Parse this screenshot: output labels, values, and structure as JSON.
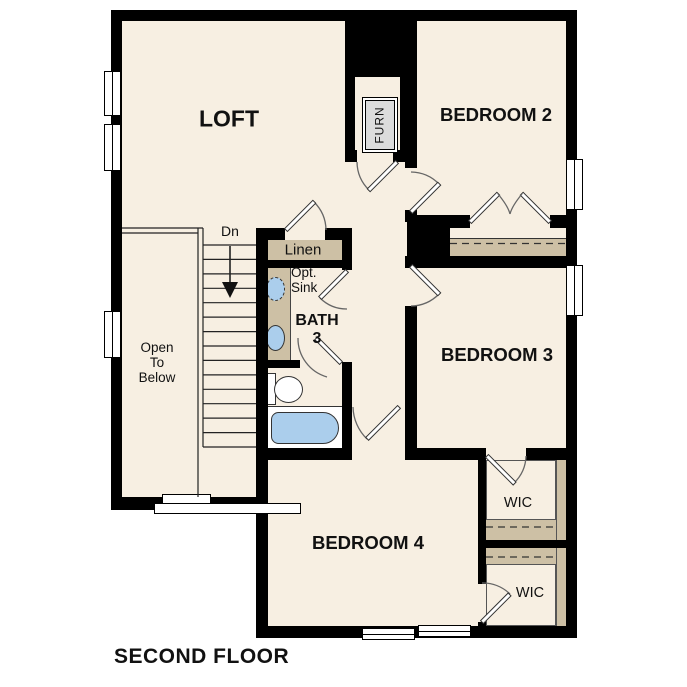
{
  "floor_plan": {
    "title": "SECOND FLOOR",
    "rooms": {
      "loft": "LOFT",
      "bedroom_2": "BEDROOM 2",
      "bedroom_3": "BEDROOM 3",
      "bedroom_4": "BEDROOM 4",
      "bath_name": "BATH",
      "bath_number": "3",
      "linen": "Linen",
      "wic_upper": "WIC",
      "wic_lower": "WIC",
      "furnace": "FURN"
    },
    "annotations": {
      "stairs_direction": "Dn",
      "open_to_below": [
        "Open",
        "To",
        "Below"
      ],
      "optional_sink": [
        "Opt.",
        "Sink"
      ]
    },
    "colors": {
      "wall": "#000000",
      "floor": "#f7efe2",
      "casework": "#cdc0a5",
      "plumbing_fixture": "#abceec",
      "background": "#ffffff"
    }
  }
}
